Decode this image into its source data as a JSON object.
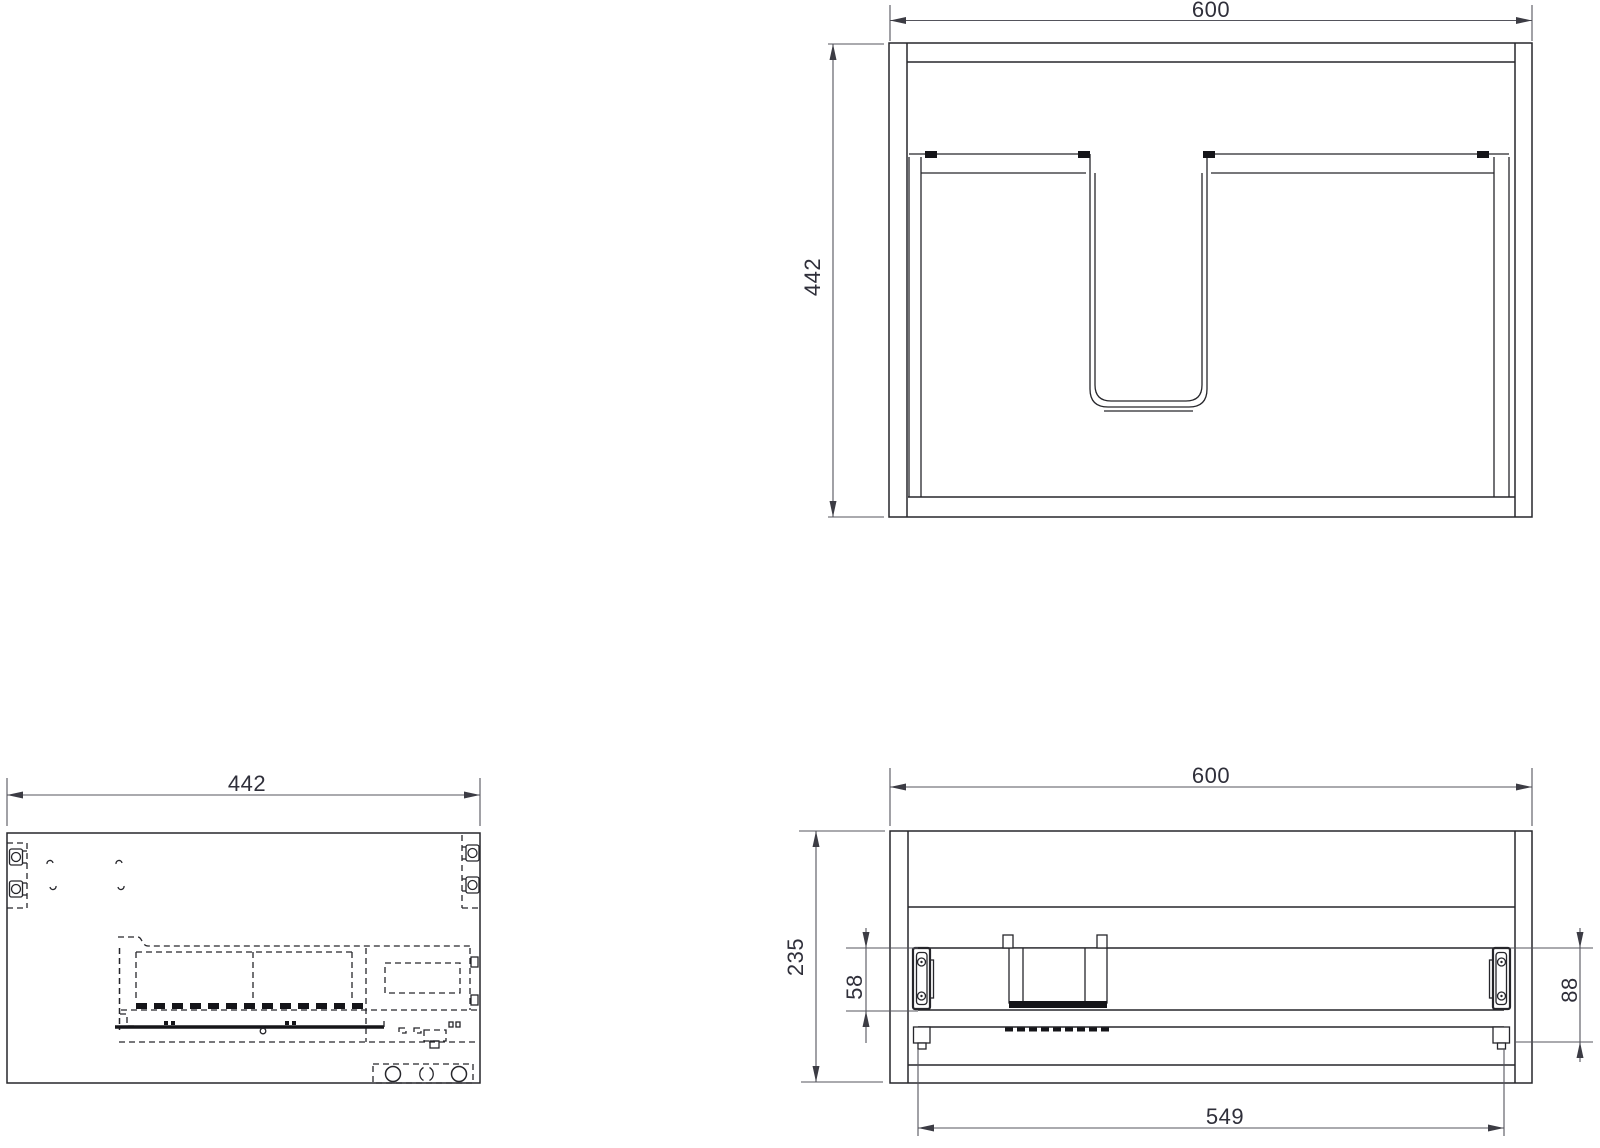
{
  "drawing": {
    "kind": "technical-drawing",
    "line_color": "#26262b",
    "dimension_color": "#54545c",
    "text_color": "#2f2f3a",
    "background": "#ffffff"
  },
  "plan_view": {
    "dim_width": "600",
    "dim_depth": "442"
  },
  "side_view": {
    "dim_depth": "442"
  },
  "front_view": {
    "dim_width": "600",
    "dim_height": "235",
    "dim_runner_offset": "58",
    "dim_bracket_drop": "88",
    "dim_runner_length": "549"
  }
}
